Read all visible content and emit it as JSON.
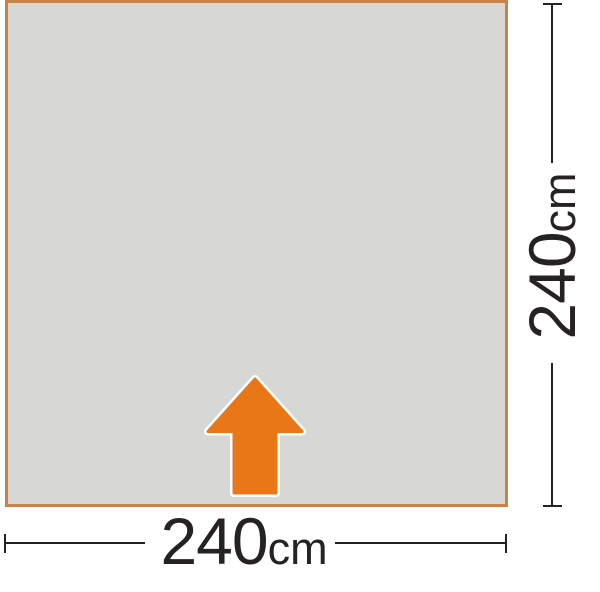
{
  "diagram": {
    "title": "groundsheet-footprint",
    "width_label": {
      "value": "240",
      "unit": "cm"
    },
    "height_label": {
      "value": "240",
      "unit": "cm"
    },
    "entrance_marker": "up-arrow-icon",
    "colors": {
      "background": "#ffffff",
      "floor_fill": "#d7d7d6",
      "floor_border": "#c8834a",
      "arrow_fill": "#e97617",
      "arrow_outline": "#ffffff",
      "dimension_line": "#262223",
      "label_color": "#262223"
    }
  }
}
